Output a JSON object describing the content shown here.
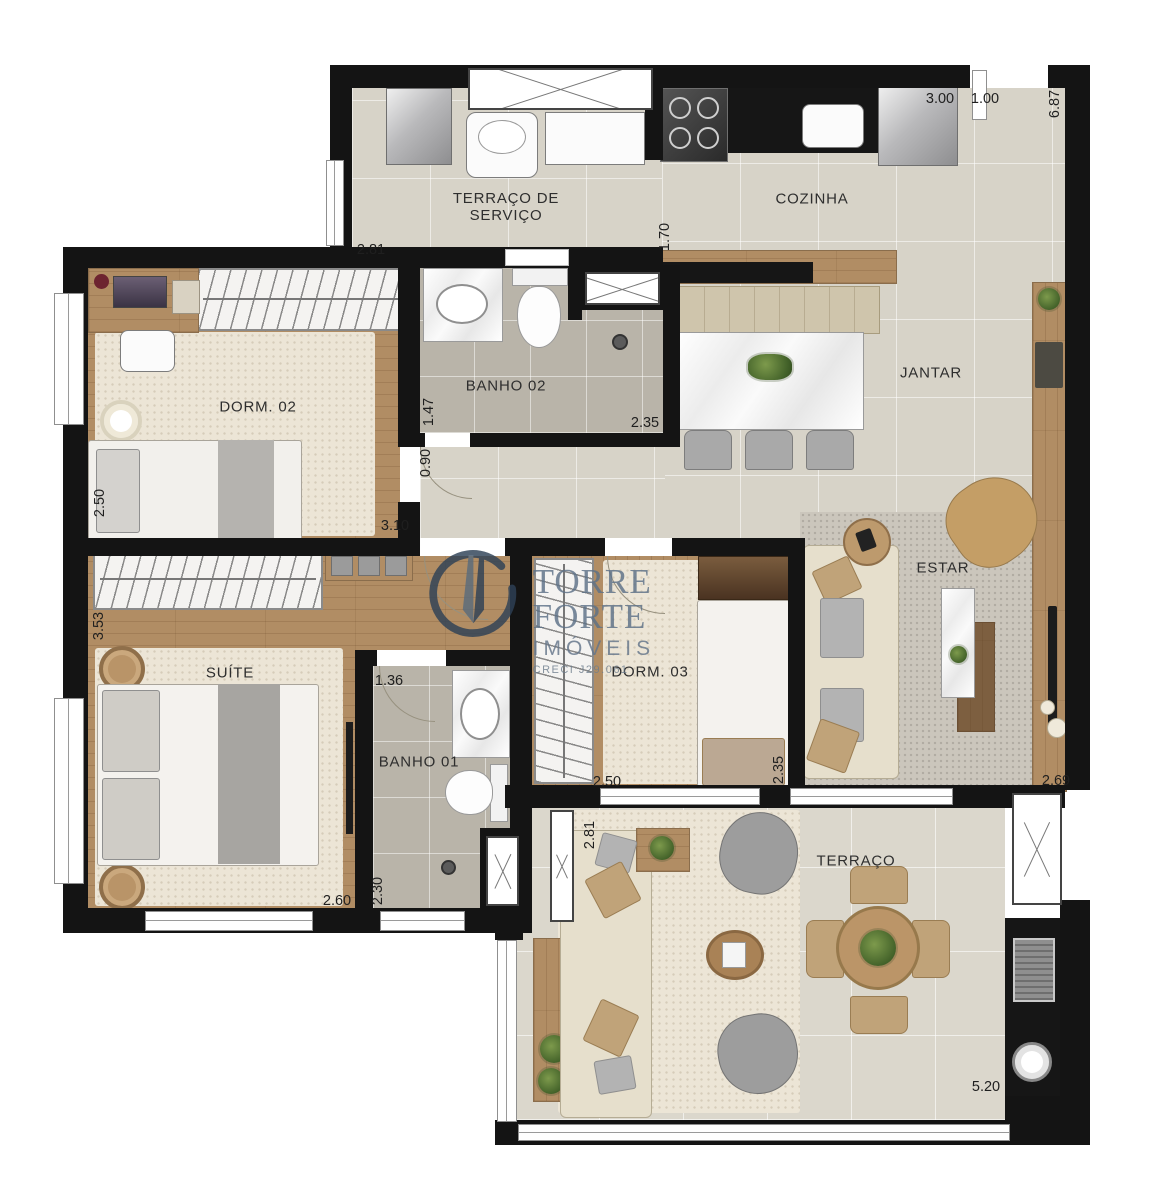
{
  "watermark": {
    "brand": "TORRE FORTE",
    "subtitle": "IMÓVEIS",
    "license": "CRECI J29.061",
    "emblem_color": "#2e4156",
    "text_color": "#5d7187"
  },
  "rooms": {
    "servico": "TERRAÇO DE\nSERVIÇO",
    "cozinha": "COZINHA",
    "dorm02": "DORM. 02",
    "banho02": "BANHO 02",
    "jantar": "JANTAR",
    "suite": "SUÍTE",
    "banho01": "BANHO 01",
    "dorm03": "DORM. 03",
    "estar": "ESTAR",
    "terraco": "TERRAÇO"
  },
  "dims": [
    {
      "v": "3.00"
    },
    {
      "v": "1.00"
    },
    {
      "v": "6.87"
    },
    {
      "v": "2.81"
    },
    {
      "v": "1.70"
    },
    {
      "v": "1.47"
    },
    {
      "v": "2.35"
    },
    {
      "v": "0.90"
    },
    {
      "v": "2.50"
    },
    {
      "v": "3.10"
    },
    {
      "v": "3.53"
    },
    {
      "v": "1.36"
    },
    {
      "v": "2.60"
    },
    {
      "v": "2.30"
    },
    {
      "v": "2.50"
    },
    {
      "v": "2.35"
    },
    {
      "v": "2.69"
    },
    {
      "v": "2.81"
    },
    {
      "v": "5.20"
    }
  ],
  "colors": {
    "wall": "#141414",
    "floor_tile": "#d7d3c8",
    "wood": "#b18d64",
    "carpet": "#ece5d6"
  }
}
